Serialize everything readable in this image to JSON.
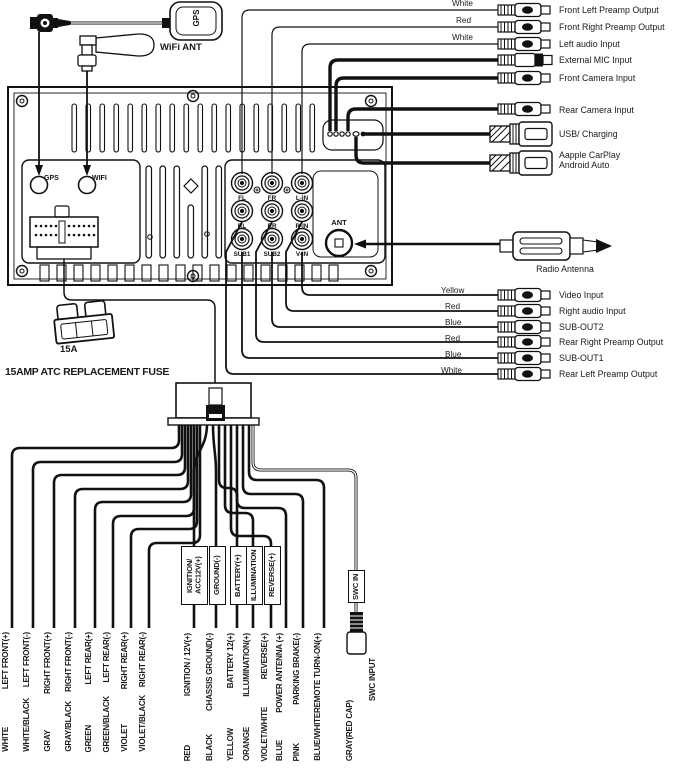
{
  "unit": {
    "gps_antenna_label": "GPS",
    "wifi_antenna_label": "WiFi ANT",
    "gps_port_label": "GPS",
    "wifi_port_label": "WIFI",
    "ant_port_label": "ANT",
    "jack_labels": [
      "FL",
      "FR",
      "L-IN",
      "RL",
      "RR",
      "R-IN",
      "SUB1",
      "SUB2",
      "V-IN"
    ]
  },
  "fuse": {
    "rating": "15A",
    "caption": "15AMP ATC REPLACEMENT FUSE"
  },
  "radio_antenna_label": "Radio Antenna",
  "outputs_top": [
    {
      "wire_color": "White",
      "label": "Front Left Preamp Output"
    },
    {
      "wire_color": "Red",
      "label": "Front Right Preamp Output"
    },
    {
      "wire_color": "White",
      "label": "Left audio Input"
    },
    {
      "wire_color": "",
      "label": "External MIC Input"
    },
    {
      "wire_color": "",
      "label": "Front Camera Input"
    },
    {
      "wire_color": "",
      "label": "Rear Camera Input"
    },
    {
      "wire_color": "",
      "label": "USB/ Charging"
    },
    {
      "wire_color": "",
      "label": "Aapple CarPlay\nAndroid Auto"
    }
  ],
  "outputs_mid": [
    {
      "wire_color": "Yellow",
      "label": "Video Input"
    },
    {
      "wire_color": "Red",
      "label": "Right audio Input"
    },
    {
      "wire_color": "Blue",
      "label": "SUB-OUT2"
    },
    {
      "wire_color": "Red",
      "label": "Rear Right Preamp Output"
    },
    {
      "wire_color": "Blue",
      "label": "SUB-OUT1"
    },
    {
      "wire_color": "White",
      "label": "Rear Left Preamp Output"
    }
  ],
  "harness": {
    "speaker_wires": [
      {
        "color": "WHITE",
        "function": "LEFT FRONT(+)"
      },
      {
        "color": "WHITE/BLACK",
        "function": "LEFT FRONT(-)"
      },
      {
        "color": "GRAY",
        "function": "RIGHT FRONT(+)"
      },
      {
        "color": "GRAY/BLACK",
        "function": "RIGHT FRONT(-)"
      },
      {
        "color": "GREEN",
        "function": "LEFT REAR(+)"
      },
      {
        "color": "GREEN/BLACK",
        "function": "LEFT REAR(-)"
      },
      {
        "color": "VIOLET",
        "function": "RIGHT REAR(+)"
      },
      {
        "color": "VIOLET/BLACK",
        "function": "RIGHT REAR(-)"
      }
    ],
    "power_wires": [
      {
        "tag": "IGNITION/\nACC12V(+)",
        "color": "RED",
        "function": "IGNITION / 12V(+)"
      },
      {
        "tag": "GROUND(-)",
        "color": "BLACK",
        "function": "CHASSIS GROUND(-)"
      },
      {
        "tag": "BATTERY(+)",
        "color": "YELLOW",
        "function": "BATTERY 12(+)"
      },
      {
        "tag": "ILLUMINATION",
        "color": "ORANGE",
        "function": "ILLUMINATION(+)"
      },
      {
        "tag": "REVERSE(+)",
        "color": "VIOLET/WHITE",
        "function": "REVERSE(+)"
      }
    ],
    "aux_wires": [
      {
        "color": "BLUE",
        "function": "POWER ANTENNA (+)"
      },
      {
        "color": "PINK",
        "function": "PARKING BRAKE(-)"
      },
      {
        "color": "BLUE/WHITE",
        "function": "REMOTE TURN-ON(+)"
      }
    ],
    "swc_wire": {
      "tag": "SWC IN",
      "color": "GRAY(RED CAP)",
      "function": "SWC INPUT"
    }
  }
}
